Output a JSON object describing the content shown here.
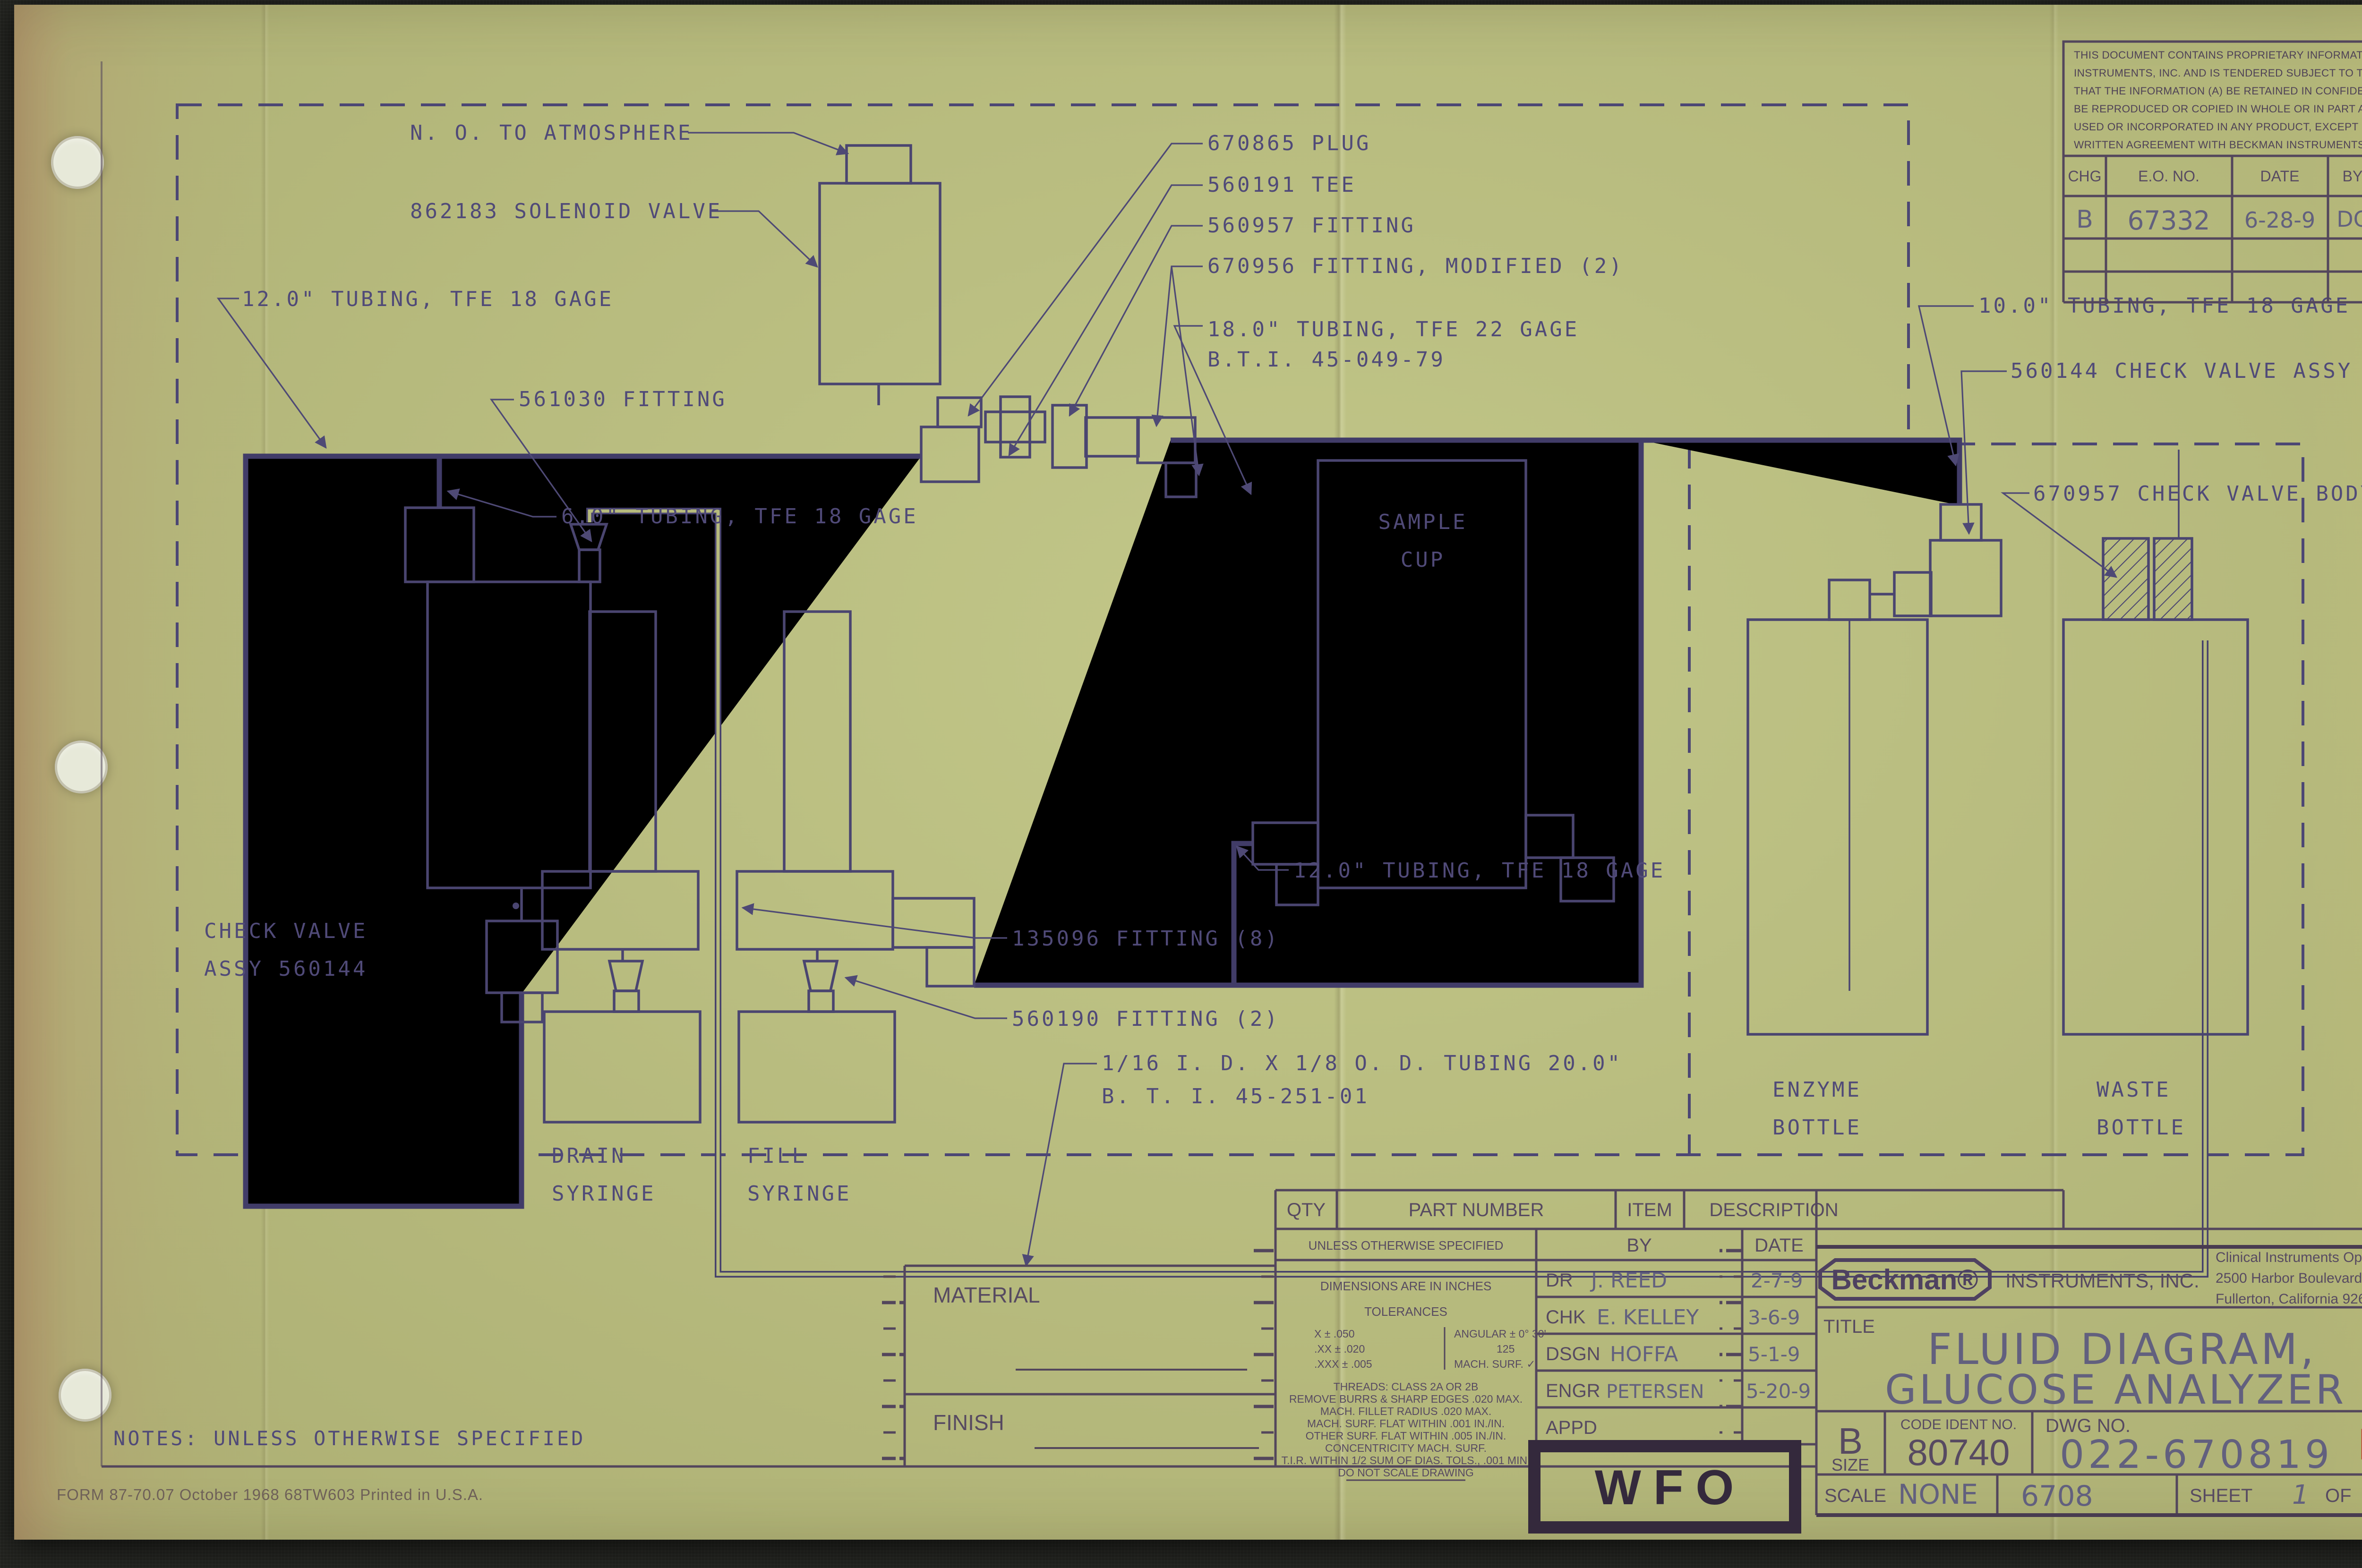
{
  "diagram": {
    "n_o_to_atmosphere": "N. O. TO ATMOSPHERE",
    "solenoid_valve": "862183 SOLENOID VALVE",
    "tubing_12_top": "12.0\" TUBING, TFE 18 GAGE",
    "fitting_561030": "561030 FITTING",
    "tubing_6": "6.0\" TUBING, TFE 18 GAGE",
    "plug_670865": "670865 PLUG",
    "tee_560191": "560191 TEE",
    "fitting_560957": "560957 FITTING",
    "fitting_670956": "670956 FITTING, MODIFIED (2)",
    "tubing_18_line1": "18.0\" TUBING, TFE 22 GAGE",
    "tubing_18_line2": "B.T.I. 45-049-79",
    "tubing_10": "10.0\" TUBING, TFE 18 GAGE",
    "check_valve_assy_560144": "560144 CHECK VALVE ASSY",
    "check_valve_body_670957": "670957 CHECK VALVE BODY",
    "sample_cup_1": "SAMPLE",
    "sample_cup_2": "CUP",
    "tubing_12_mid": "12.0\" TUBING, TFE 18 GAGE",
    "fitting_135096": "135096 FITTING (8)",
    "fitting_560190": "560190 FITTING (2)",
    "check_valve_left_1": "CHECK VALVE",
    "check_valve_left_2": "ASSY 560144",
    "drain_1": "DRAIN",
    "drain_2": "SYRINGE",
    "fill_1": "FILL",
    "fill_2": "SYRINGE",
    "enzyme_1": "ENZYME",
    "enzyme_2": "BOTTLE",
    "waste_1": "WASTE",
    "waste_2": "BOTTLE",
    "tubing_116_line1": "1/16 I. D. X 1/8 O. D. TUBING 20.0\"",
    "tubing_116_line2": "B. T. I. 45-251-01"
  },
  "revision": {
    "notice_lines": [
      "THIS DOCUMENT CONTAINS PROPRIETARY INFORMATION OF BECKMAN",
      "INSTRUMENTS, INC. AND IS TENDERED SUBJECT TO THE CONDITIONS",
      "THAT THE INFORMATION (A) BE RETAINED IN CONFIDENCE, (B) NOT",
      "BE REPRODUCED OR COPIED IN WHOLE OR IN PART AND (C) NOT BE",
      "USED OR INCORPORATED IN ANY PRODUCT, EXCEPT UNDER AN EXPRESS",
      "WRITTEN AGREEMENT WITH BECKMAN INSTRUMENTS, INC."
    ],
    "headers": [
      "CHG",
      "E.O. NO.",
      "DATE",
      "BY",
      "CHK"
    ],
    "row": {
      "chg": "B",
      "eo_no": "67332",
      "date": "6-28-9",
      "by": "DC"
    }
  },
  "parts_strip": {
    "qty": "QTY",
    "part_number": "PART NUMBER",
    "item": "ITEM",
    "description": "DESCRIPTION"
  },
  "material": {
    "material_label": "MATERIAL",
    "finish_label": "FINISH"
  },
  "specs": {
    "heading": "UNLESS OTHERWISE SPECIFIED",
    "dims": "DIMENSIONS ARE IN INCHES",
    "tolerances": "TOLERANCES",
    "tol_x": "X ± .050",
    "tol_xx": ".XX ± .020",
    "tol_xxx": ".XXX ± .005",
    "angular": "ANGULAR ± 0° 30'",
    "surf_num": "125",
    "mach_surf": "MACH. SURF. ✓",
    "lines": [
      "THREADS: CLASS 2A OR 2B",
      "REMOVE BURRS & SHARP EDGES .020 MAX.",
      "MACH. FILLET RADIUS .020 MAX.",
      "MACH. SURF. FLAT WITHIN .001 IN./IN.",
      "OTHER SURF. FLAT WITHIN .005 IN./IN.",
      "CONCENTRICITY MACH. SURF.",
      "T.I.R. WITHIN 1/2 SUM OF DIAS. TOLS., .001 MIN.",
      "DO NOT SCALE DRAWING"
    ]
  },
  "approvals": {
    "by_label": "BY",
    "date_label": "DATE",
    "rows": [
      {
        "role": "DR",
        "name": "J. REED",
        "date": "2-7-9"
      },
      {
        "role": "CHK",
        "name": "E. KELLEY",
        "date": "3-6-9"
      },
      {
        "role": "DSGN",
        "name": "HOFFA",
        "date": "5-1-9"
      },
      {
        "role": "ENGR",
        "name": "PETERSEN",
        "date": "5-20-9"
      },
      {
        "role": "APPD",
        "name": "",
        "date": ""
      }
    ]
  },
  "company": {
    "logo": "Beckman®",
    "suffix": "INSTRUMENTS, INC.",
    "address": [
      "Clinical Instruments Operations",
      "2500 Harbor Boulevard",
      "Fullerton, California 92634"
    ]
  },
  "title_block": {
    "title_label": "TITLE",
    "title_line1": "FLUID DIAGRAM,",
    "title_line2": "GLUCOSE ANALYZER",
    "size_letter": "B",
    "size_label": "SIZE",
    "code_label": "CODE IDENT NO.",
    "code_value": "80740",
    "dwg_label": "DWG NO.",
    "dwg_value": "022-670819",
    "rev_letter": "B",
    "scale_label": "SCALE",
    "scale_value": "NONE",
    "job_number": "6708",
    "sheet_label": "SHEET",
    "sheet_value": "1",
    "of_label": "OF",
    "of_value": "1"
  },
  "stamp": {
    "text": "WFO"
  },
  "notes": "NOTES: UNLESS OTHERWISE SPECIFIED",
  "form_footer": "FORM 87-70.07   October 1968   68TW603   Printed in U.S.A."
}
